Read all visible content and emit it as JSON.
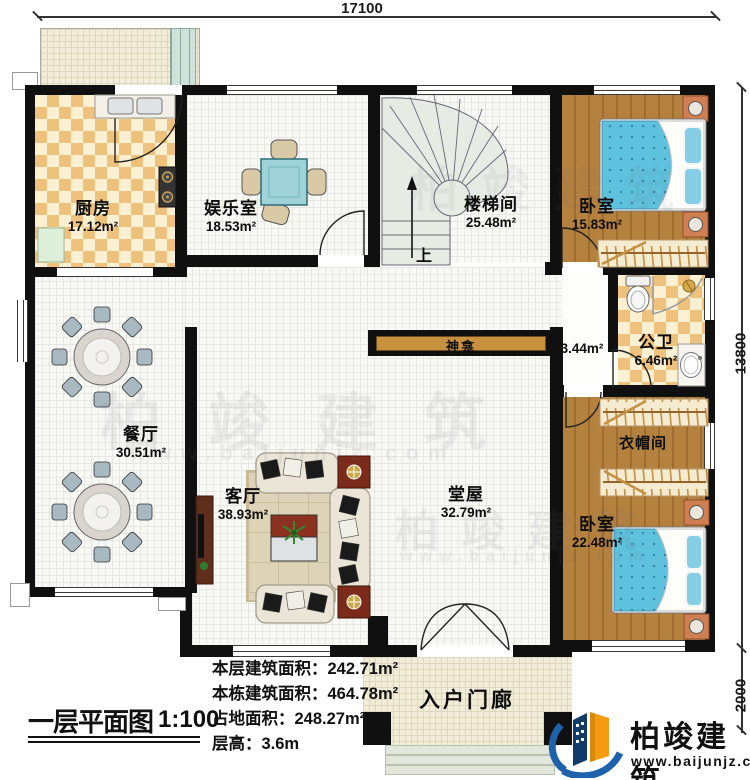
{
  "dimensions": {
    "top_width": "17100",
    "right_height": "13800",
    "porch_depth": "2000"
  },
  "rooms": {
    "kitchen": {
      "name": "厨房",
      "area": "17.12m²"
    },
    "entertainment": {
      "name": "娱乐室",
      "area": "18.53m²"
    },
    "stairwell": {
      "name": "楼梯间",
      "area": "25.48m²",
      "direction": "上"
    },
    "bedroom_top": {
      "name": "卧室",
      "area": "15.83m²"
    },
    "corridor": {
      "area": "3.44m²"
    },
    "bathroom": {
      "name": "公卫",
      "area": "6.46m²"
    },
    "cloakroom": {
      "name": "衣帽间"
    },
    "bedroom_bottom": {
      "name": "卧室",
      "area": "22.48m²"
    },
    "hall": {
      "name": "堂屋",
      "area": "32.79m²"
    },
    "living": {
      "name": "客厅",
      "area": "38.93m²"
    },
    "dining": {
      "name": "餐厅",
      "area": "30.51m²"
    },
    "shrine": {
      "name": "神龛"
    },
    "porch": {
      "name": "入户门廊"
    }
  },
  "title_block": {
    "plan_title": "一层平面图",
    "scale": "1:100",
    "stats": [
      {
        "label": "本层建筑面积：",
        "value": "242.71m²"
      },
      {
        "label": "本栋建筑面积：",
        "value": "464.78m²"
      },
      {
        "label": "占地面积：",
        "value": "248.27m²"
      },
      {
        "label": "层高：",
        "value": "3.6m"
      }
    ]
  },
  "branding": {
    "company": "柏竣建筑",
    "website": "www.baijunjz.com",
    "logo_icon": "building-swoosh-icon"
  }
}
